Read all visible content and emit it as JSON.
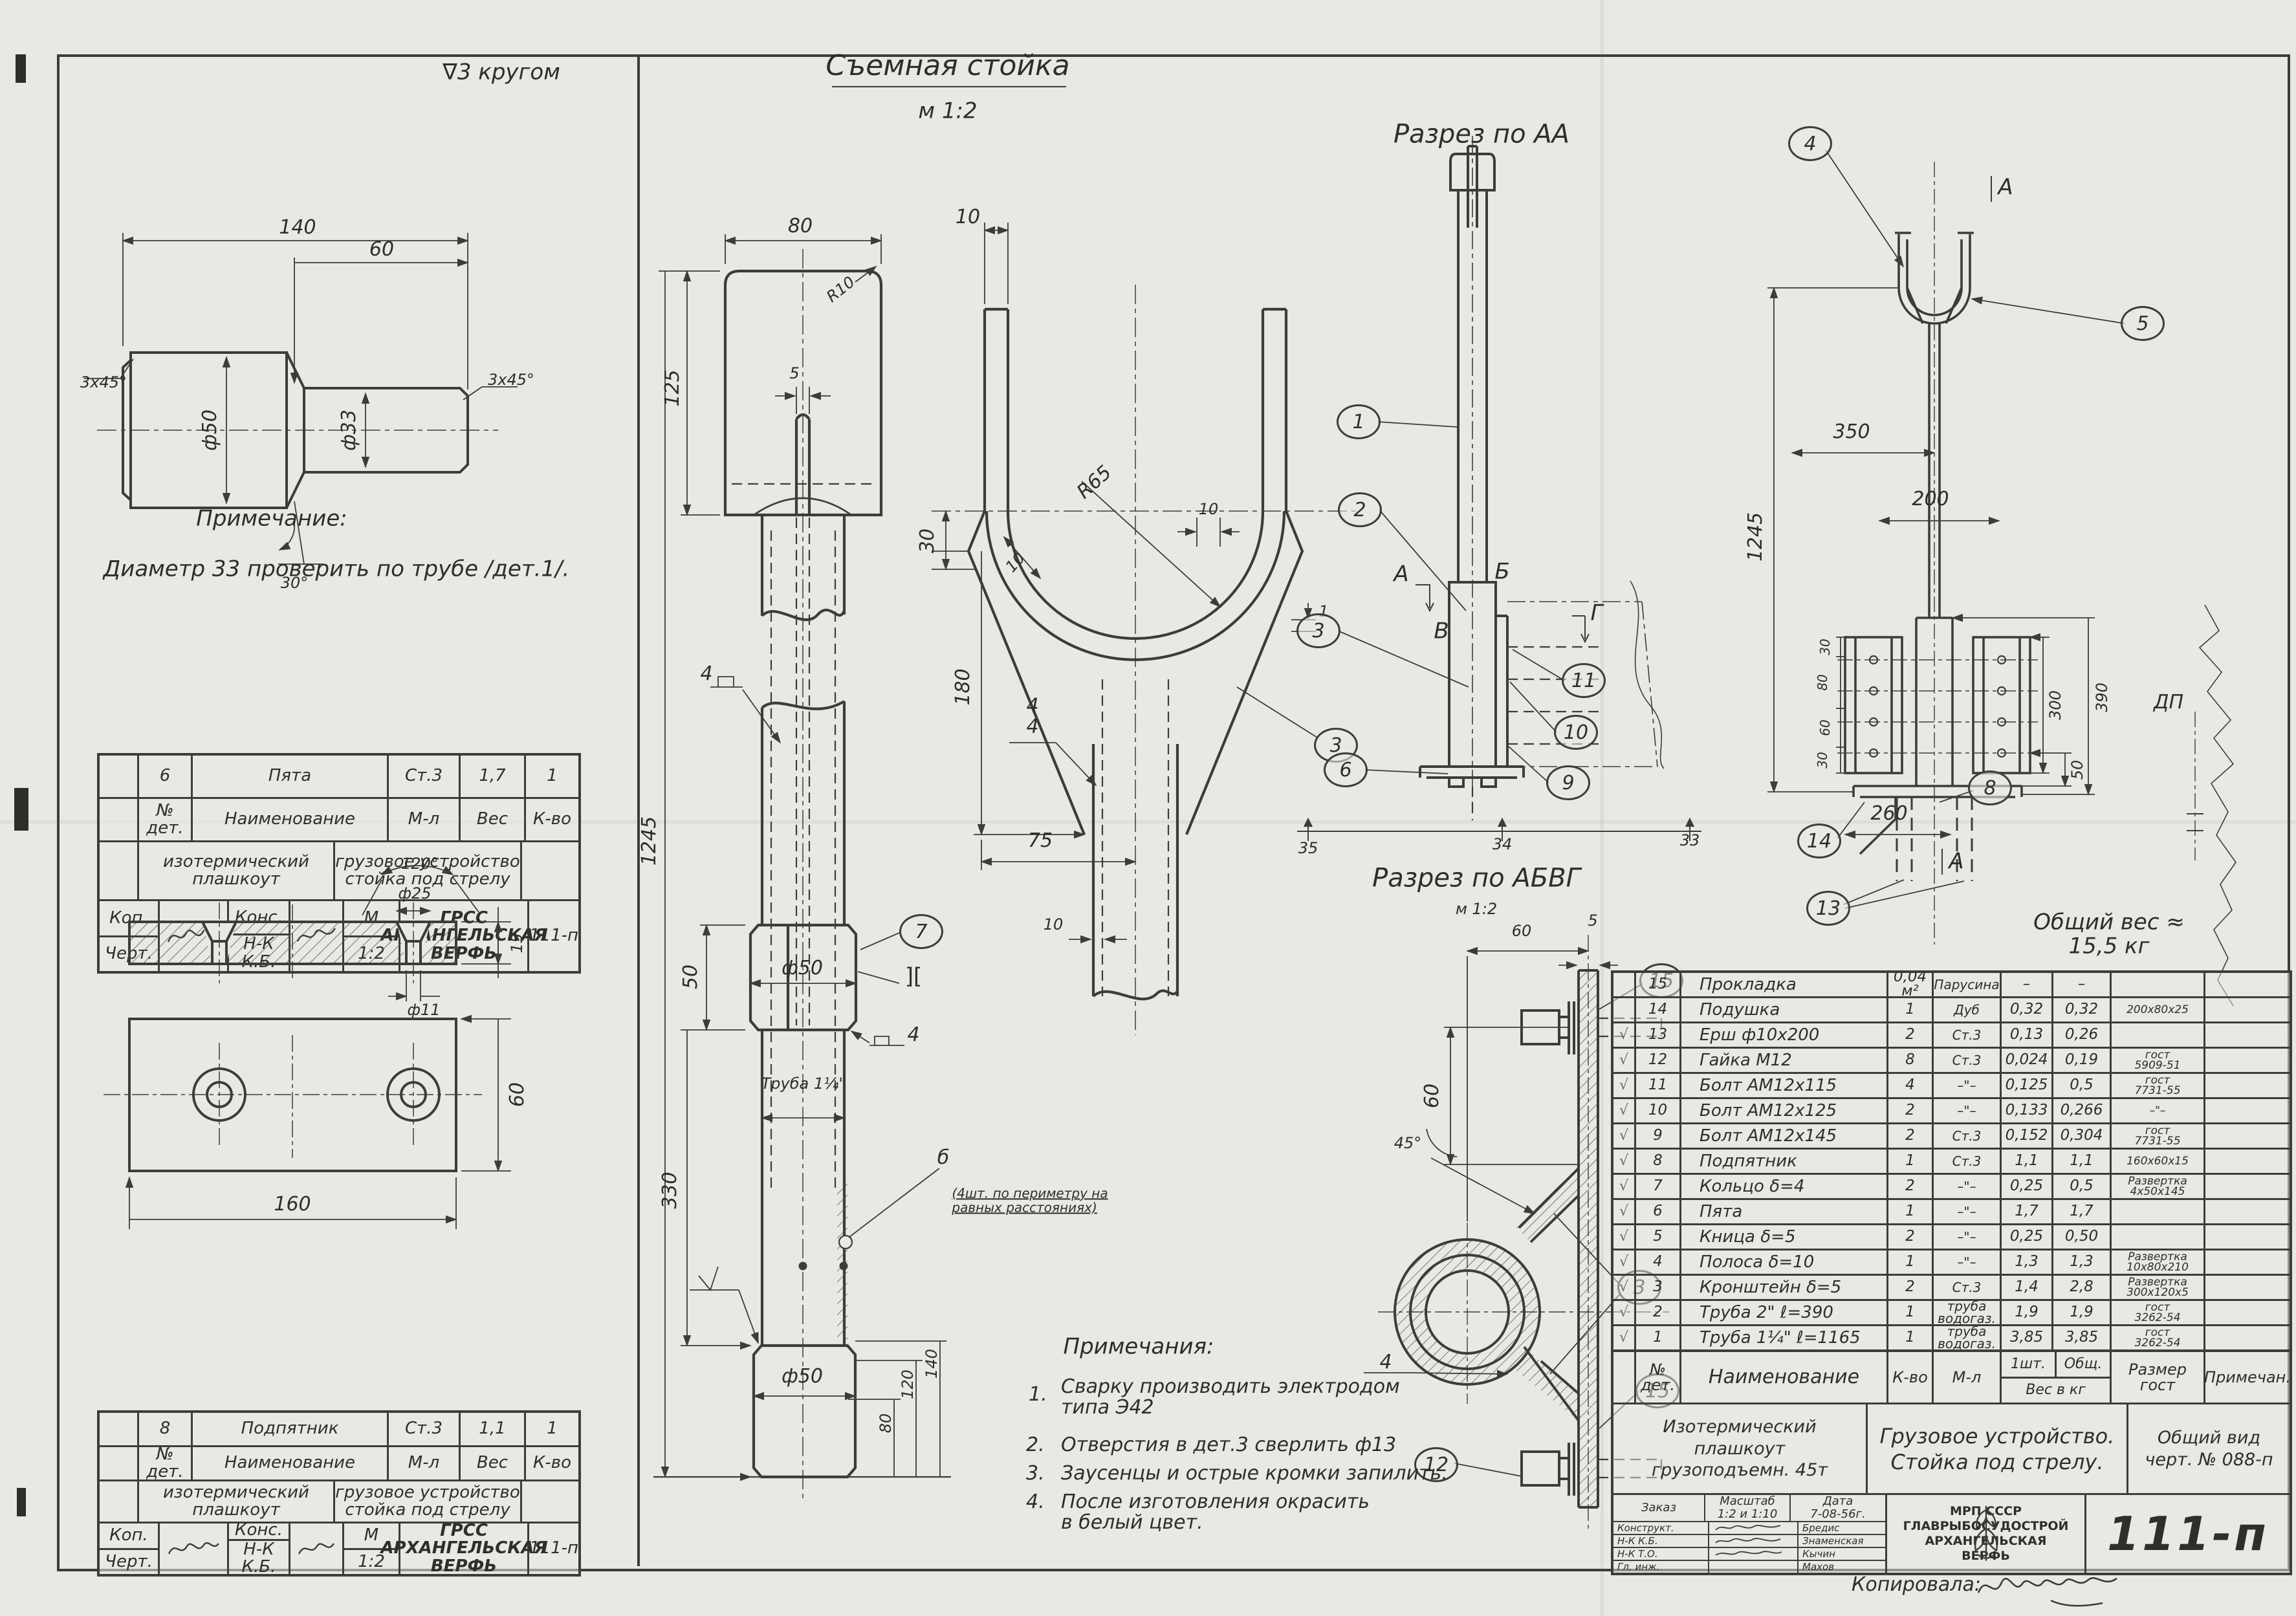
{
  "left": {
    "finish_note": "∇3 кругом",
    "shaft_dims": {
      "len": "140",
      "len2": "60",
      "cham_l": "3х45°",
      "cham_r": "3х45°",
      "d_big": "ф50",
      "d_small": "ф33",
      "angle": "30°"
    },
    "note": {
      "title": "Примечание:",
      "text": "Диаметр 33 проверить по трубе /дет.1/."
    },
    "plate_dims": {
      "angle": "120°",
      "d_top": "ф25",
      "thick": "15",
      "d_hole": "ф11",
      "height": "60",
      "width": "160"
    },
    "block_pyata": {
      "num": "6",
      "name": "Пята",
      "mat": "Ст.3",
      "weight": "1,7",
      "qty": "1"
    },
    "block_podpyatnik": {
      "num": "8",
      "name": "Подпятник",
      "mat": "Ст.3",
      "weight": "1,1",
      "qty": "1"
    },
    "block_common": {
      "h_num": "№\nдет.",
      "h_name": "Наименование",
      "h_mat": "М-л",
      "h_weight": "Вес",
      "h_qty": "К-во",
      "project": "изотермический\nплашкоут",
      "device": "грузовое устройство\nстойка под стрелу",
      "kop": "Коп.",
      "chert": "Черт.",
      "kons": "Конс.",
      "nk": "Н-К\nК.Б.",
      "m": "М",
      "scale": "1:2",
      "org": "ГРСС\nАРХАНГЕЛЬСКАЯ\nВЕРФЬ",
      "code": "111-п"
    }
  },
  "front": {
    "title": "Съемная стойка",
    "scale": "м 1:2",
    "d80": "80",
    "r10": "R10",
    "d5": "5",
    "d125": "125",
    "d1245": "1245",
    "d50c": "50",
    "phi50_top": "ф50",
    "weld4a": "4",
    "weld4b": "4",
    "weld_ii": "][",
    "pipe": "Труба 1¼\"",
    "d330": "330",
    "hole_tag": "б",
    "hole_note": "(4шт. по периметру на\nравных расстояниях)",
    "phi50_bot": "ф50",
    "d140": "140",
    "d120": "120",
    "d80b": "80",
    "c7": "7"
  },
  "side": {
    "d10top": "10",
    "d30": "30",
    "r65": "R65",
    "d10a": "10",
    "d10b": "10",
    "d1": "1",
    "d180": "180",
    "d75": "75",
    "d10c": "10",
    "weld44": "4\n4",
    "c3": "3"
  },
  "aa": {
    "title": "Разрез по АА",
    "lA": "А",
    "lB": "Б",
    "lV": "В",
    "lG": "Г",
    "c1": "1",
    "c2": "2",
    "c3": "3",
    "c6": "6",
    "c9": "9",
    "c10": "10",
    "c11": "11",
    "r35": "35",
    "r34": "34",
    "r33": "33"
  },
  "right": {
    "c4": "4",
    "c5": "5",
    "c8": "8",
    "c13": "13",
    "c14": "14",
    "mA_top": "А",
    "mA_bot": "А",
    "d1245": "1245",
    "d350": "350",
    "d200": "200",
    "d30a": "30",
    "d80": "80",
    "d60": "60",
    "d30b": "30",
    "d300": "300",
    "d390": "390",
    "d50": "50",
    "d260": "260",
    "dp": "ДП"
  },
  "abvg": {
    "title": "Разрез по АБВГ",
    "scale": "м 1:2",
    "d60top": "60",
    "d5": "5",
    "d60": "60",
    "d45": "45°",
    "c15a": "15",
    "c3": "3",
    "c15b": "15",
    "c12": "12",
    "weld4": "4"
  },
  "notes": {
    "title": "Примечания:",
    "items": [
      {
        "n": "1.",
        "t": "Сварку производить электродом\nтипа Э42"
      },
      {
        "n": "2.",
        "t": "Отверстия в дет.3 сверлить ф13"
      },
      {
        "n": "3.",
        "t": "Заусенцы и острые кромки запилить."
      },
      {
        "n": "4.",
        "t": "После изготовления окрасить\nв белый цвет."
      }
    ]
  },
  "total_weight": "Общий вес ≈ 15,5 кг",
  "table": {
    "header": {
      "num": "№\nдет.",
      "name": "Наименование",
      "qty": "К-во",
      "mat": "М-л",
      "w1": "1шт.",
      "w2": "Общ.",
      "wlabel": "Вес в кг",
      "size": "Размер\nгост",
      "note": "Примечан."
    },
    "rows": [
      {
        "check": "",
        "num": "15",
        "name": "Прокладка",
        "qty": "0,04\nм²",
        "mat": "Парусина",
        "w1": "–",
        "w2": "–",
        "size": ""
      },
      {
        "check": "",
        "num": "14",
        "name": "Подушка",
        "qty": "1",
        "mat": "Дуб",
        "w1": "0,32",
        "w2": "0,32",
        "size": "200х80х25"
      },
      {
        "check": "√",
        "num": "13",
        "name": "Ерш  ф10х200",
        "qty": "2",
        "mat": "Ст.3",
        "w1": "0,13",
        "w2": "0,26",
        "size": ""
      },
      {
        "check": "√",
        "num": "12",
        "name": "Гайка  М12",
        "qty": "8",
        "mat": "Ст.3",
        "w1": "0,024",
        "w2": "0,19",
        "size": "гост\n5909-51"
      },
      {
        "check": "√",
        "num": "11",
        "name": "Болт  АМ12х115",
        "qty": "4",
        "mat": "–\"–",
        "w1": "0,125",
        "w2": "0,5",
        "size": "гост\n7731-55"
      },
      {
        "check": "√",
        "num": "10",
        "name": "Болт  АМ12х125",
        "qty": "2",
        "mat": "–\"–",
        "w1": "0,133",
        "w2": "0,266",
        "size": "–\"–"
      },
      {
        "check": "√",
        "num": "9",
        "name": "Болт  АМ12х145",
        "qty": "2",
        "mat": "Ст.3",
        "w1": "0,152",
        "w2": "0,304",
        "size": "гост\n7731-55"
      },
      {
        "check": "√",
        "num": "8",
        "name": "Подпятник",
        "qty": "1",
        "mat": "Ст.3",
        "w1": "1,1",
        "w2": "1,1",
        "size": "160х60х15"
      },
      {
        "check": "√",
        "num": "7",
        "name": "Кольцо  δ=4",
        "qty": "2",
        "mat": "–\"–",
        "w1": "0,25",
        "w2": "0,5",
        "size": "Развертка\n4х50х145"
      },
      {
        "check": "√",
        "num": "6",
        "name": "Пята",
        "qty": "1",
        "mat": "–\"–",
        "w1": "1,7",
        "w2": "1,7",
        "size": ""
      },
      {
        "check": "√",
        "num": "5",
        "name": "Кница  δ=5",
        "qty": "2",
        "mat": "–\"–",
        "w1": "0,25",
        "w2": "0,50",
        "size": ""
      },
      {
        "check": "√",
        "num": "4",
        "name": "Полоса  δ=10",
        "qty": "1",
        "mat": "–\"–",
        "w1": "1,3",
        "w2": "1,3",
        "size": "Развертка\n10х80х210"
      },
      {
        "check": "√",
        "num": "3",
        "name": "Кронштейн  δ=5",
        "qty": "2",
        "mat": "Ст.3",
        "w1": "1,4",
        "w2": "2,8",
        "size": "Развертка\n300х120х5"
      },
      {
        "check": "√",
        "num": "2",
        "name": "Труба 2\"  ℓ=390",
        "qty": "1",
        "mat": "труба\nводогаз.",
        "w1": "1,9",
        "w2": "1,9",
        "size": "гост\n3262-54"
      },
      {
        "check": "√",
        "num": "1",
        "name": "Труба 1¼\"  ℓ=1165",
        "qty": "1",
        "mat": "труба\nводогаз.",
        "w1": "3,85",
        "w2": "3,85",
        "size": "гост\n3262-54"
      }
    ]
  },
  "tb": {
    "project": "Изотермический\nплашкоут\nгрузоподъемн. 45т",
    "device": "Грузовое устройство.\nСтойка под стрелу.",
    "view": "Общий вид\nчерт. № 088-п",
    "order": "Заказ",
    "scale_l": "Масштаб",
    "scale_v": "1:2 и 1:10",
    "date_l": "Дата",
    "date_v": "7-08-56г.",
    "r1l": "Конструкт.",
    "r1n": "Бредис",
    "r2l": "Н-К К.Б.",
    "r2n": "Знаменская",
    "r3l": "Н-К Т.О.",
    "r3n": "Кычин",
    "r4l": "Гл. инж.",
    "r4n": "Махов",
    "org": "МРП СССР\nГЛАВРЫБОСУДОСТРОЙ\nАРХАНГЕЛЬСКАЯ\nВЕРФЬ",
    "code": "111-п",
    "copied": "Копировала:"
  }
}
